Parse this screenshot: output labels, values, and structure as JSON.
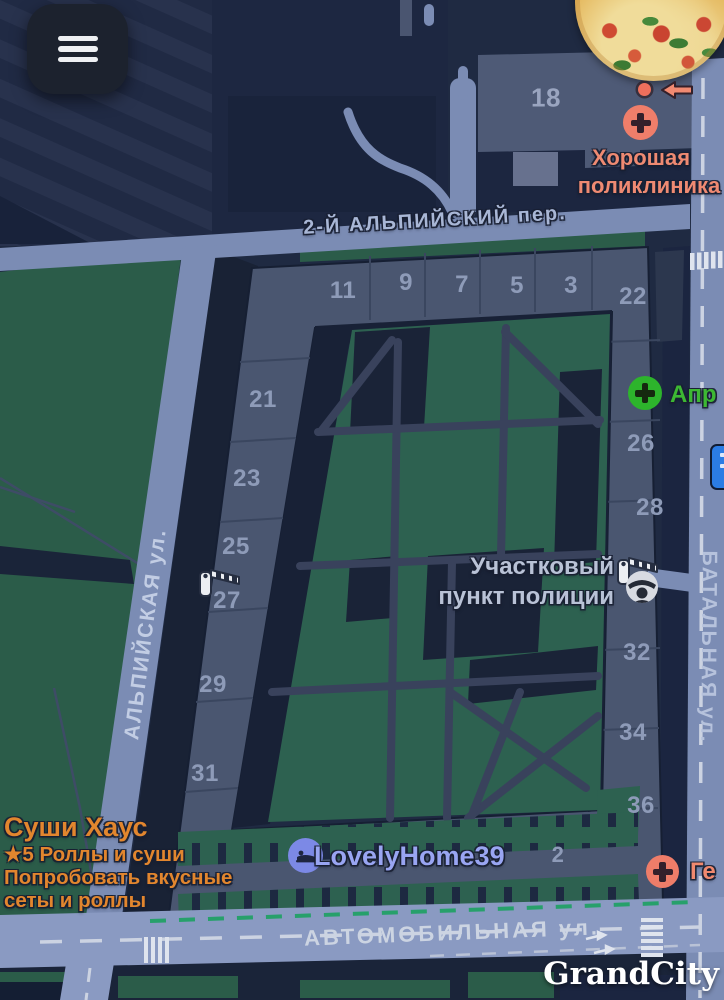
{
  "map": {
    "house_numbers": [
      "18",
      "11",
      "9",
      "7",
      "5",
      "3",
      "22",
      "21",
      "23",
      "25",
      "27",
      "29",
      "31",
      "26",
      "28",
      "32",
      "34",
      "36",
      "2"
    ],
    "streets": {
      "alpiysky_lane": "2-Й АЛЬПИЙСКИЙ пер.",
      "alpiyskaya": "АЛЬПИЙСКАЯ ул.",
      "batalnaya": "БАТАЛЬНАЯ ул.",
      "avtomobilnaya": "АВТОМОБИЛЬНАЯ ул."
    },
    "pois": {
      "clinic": {
        "line1": "Хорошая",
        "line2": "поликлиника"
      },
      "pharmacy": {
        "label": "Апр"
      },
      "police": {
        "line1": "Участковый",
        "line2": "пункт полиции"
      },
      "sushi": {
        "title": "Суши Хаус",
        "rating_line": "★5 Роллы и суши",
        "promo_line1": "Попробовать вкусные",
        "promo_line2": "сеты и роллы"
      },
      "hotel": {
        "label": "LovelyHome39"
      },
      "lab": {
        "label": "Ге"
      }
    },
    "watermark": "GrandCity",
    "colors": {
      "salmon": "#ee7e6a",
      "orange": "#e2862e",
      "pharmacy_green": "#2db42c",
      "green_text": "#3db833",
      "periwinkle": "#99a5f2",
      "road": "#7b8cb4",
      "park_green": "#2b5c49",
      "building": "#4a5670"
    }
  }
}
